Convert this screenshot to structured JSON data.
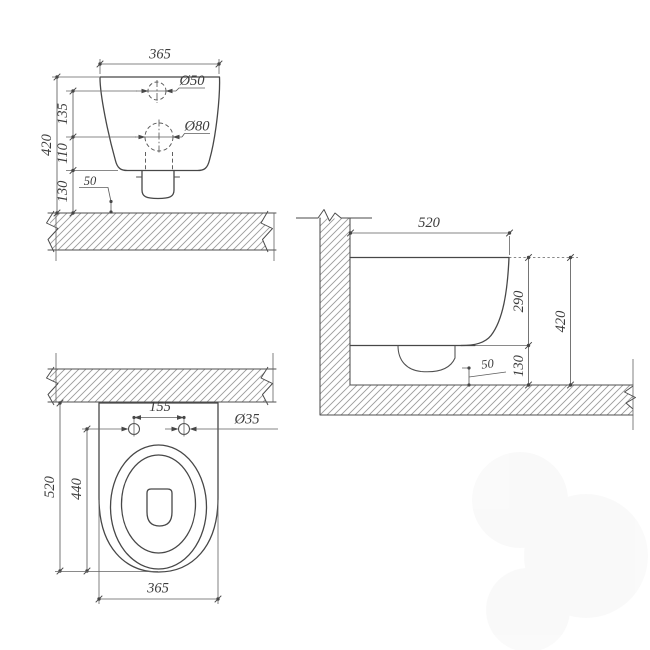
{
  "drawing": {
    "product": "wall-hung-toilet-dimension-drawing",
    "accent_line_color": "#474747",
    "hatch_color": "#9b9b9b"
  },
  "front_view": {
    "width": "365",
    "inlet_dia": "Ø50",
    "outlet_dia": "Ø80",
    "seg_top": "135",
    "seg_mid": "110",
    "seg_floor": "130",
    "height": "420",
    "outlet_offset": "50"
  },
  "side_view": {
    "depth": "520",
    "body_height": "290",
    "floor_gap": "130",
    "height": "420",
    "outlet_offset": "50"
  },
  "top_view": {
    "bolt_spacing": "155",
    "bolt_dia": "Ø35",
    "depth": "520",
    "inner_depth": "440",
    "width": "365"
  }
}
